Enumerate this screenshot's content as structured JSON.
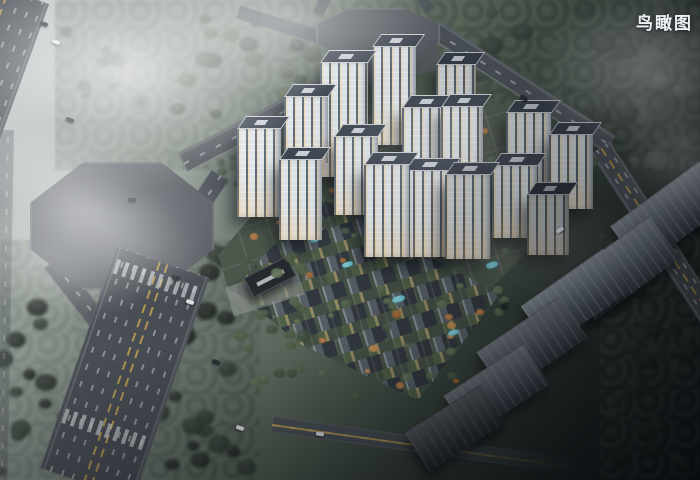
{
  "scene": {
    "title_label": "鸟瞰图",
    "counts": {
      "residential_towers": 16,
      "villa_rows": 12,
      "context_buildings": 6,
      "octagon_intersections": 2
    }
  },
  "palette": {
    "fog": "#c6cbd0",
    "forest": "#3a453e",
    "forest-dark": "#232b26",
    "road": "#4b5158",
    "road-line": "#d3d7db",
    "road-yellow": "#c2a04e",
    "plaza": "#54585f",
    "site-green": "#4a5549",
    "tower-facade": "#e4eaee",
    "tower-roof": "#3b4350",
    "villa-roof-light": "#9aa2a9",
    "villa-roof-dark": "#2f353c",
    "courtyard": "#cdb57a",
    "autumn": "#b97a40",
    "pool": "#6cc6d2",
    "slab-roof": "#99a1ac",
    "slab-face": "#525a64",
    "title-color": "#eef1f4"
  }
}
